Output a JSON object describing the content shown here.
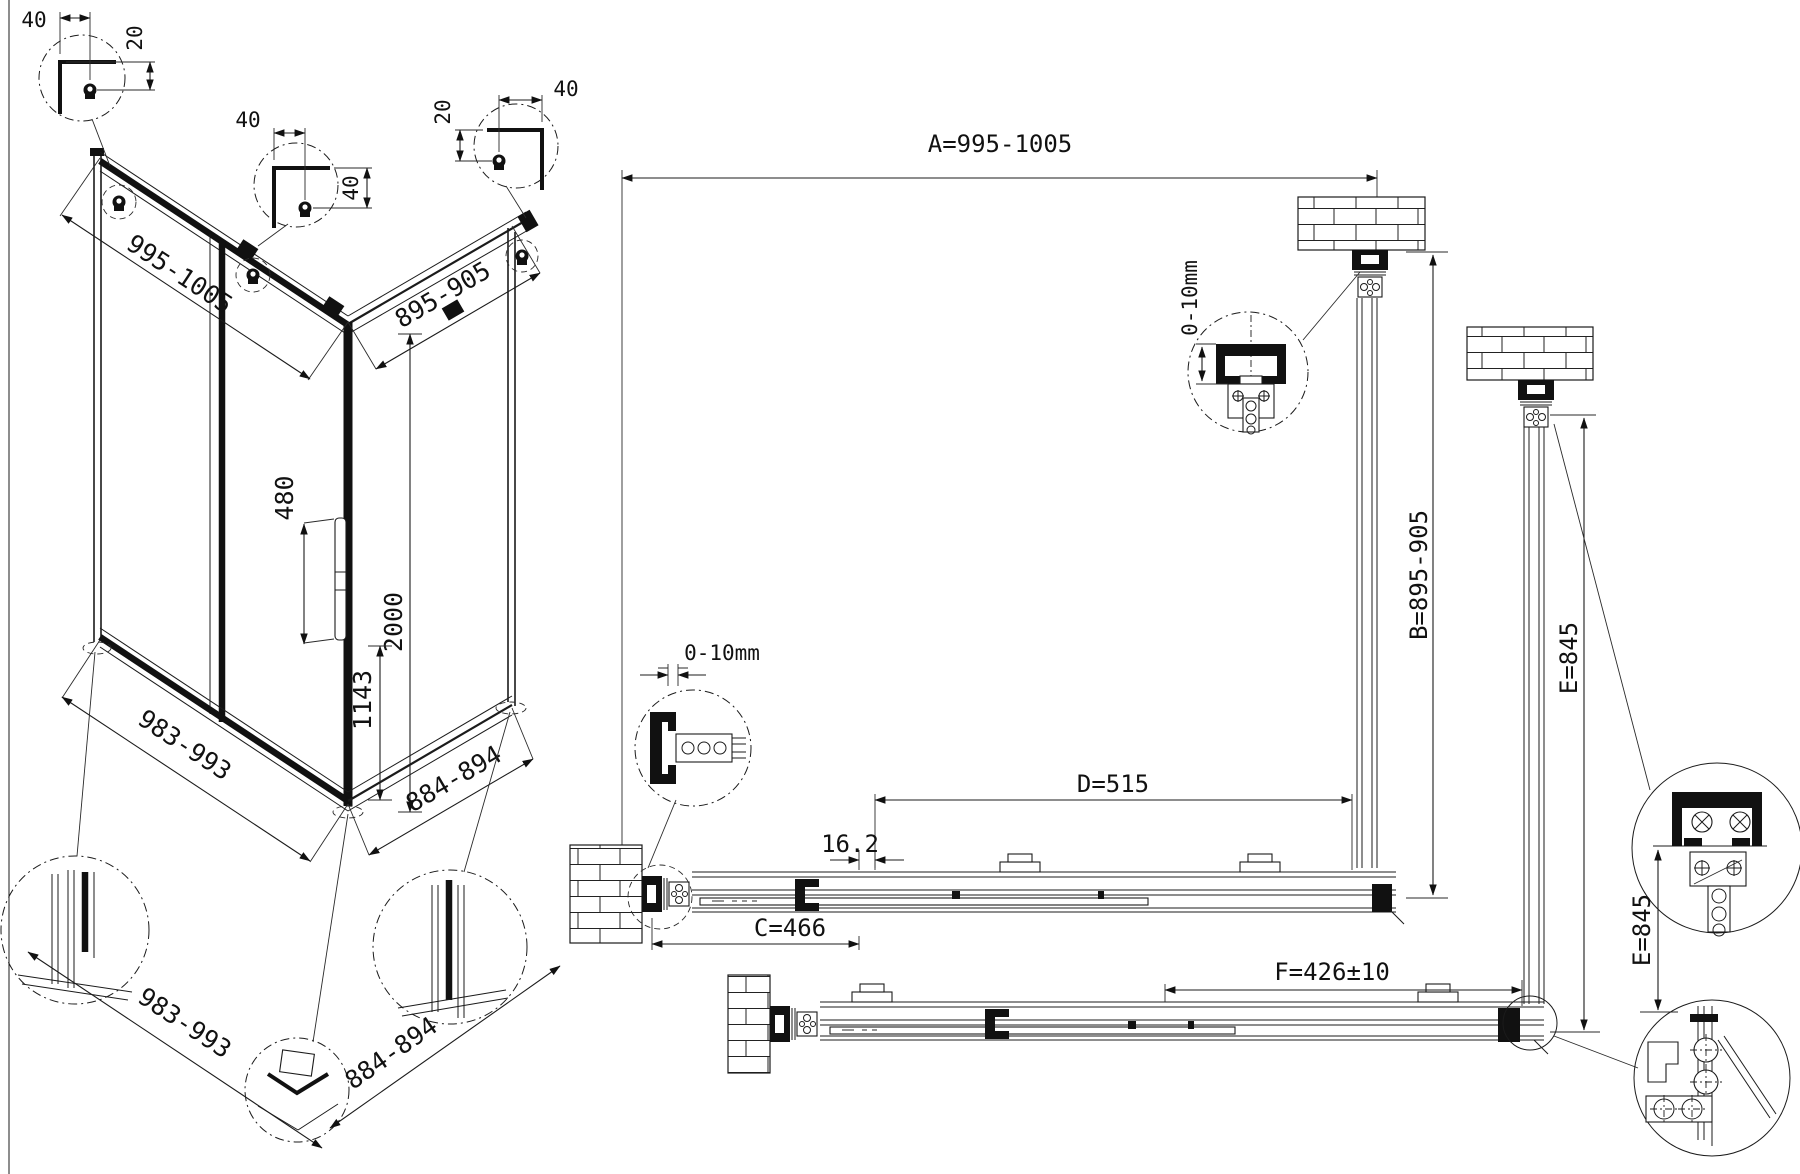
{
  "iso": {
    "top_left": "995-1005",
    "top_right": "895-905",
    "handle_len": "480",
    "height": "2000",
    "handle_h": "1143",
    "bottom_left": "983-993",
    "bottom_right": "884-894",
    "bottom_left2": "983-993",
    "bottom_right2": "884-894",
    "da_w": "40",
    "da_h": "20",
    "db_w": "40",
    "db_h": "40",
    "dc_w": "40",
    "dc_h": "20"
  },
  "plan": {
    "a": "A=995-1005",
    "b": "B=895-905",
    "c": "C=466",
    "d": "D=515",
    "e1": "E=845",
    "e2": "E=845",
    "f": "F=426±10",
    "gap1": "0-10mm",
    "gap2": "0-10mm",
    "t": "16.2"
  }
}
